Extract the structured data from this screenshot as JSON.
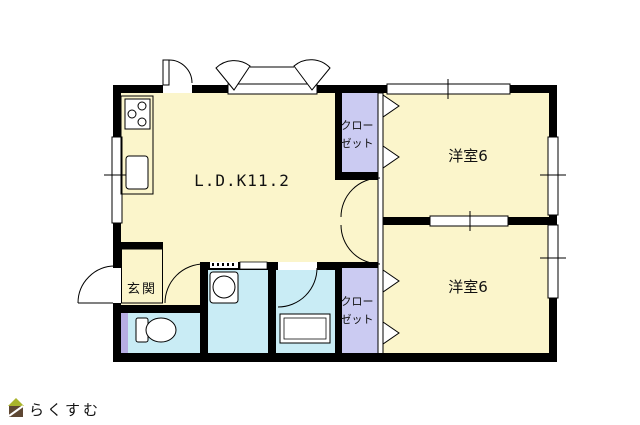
{
  "plan": {
    "type": "floor-plan",
    "rooms": {
      "ldk": {
        "label": "L.D.K11.2"
      },
      "bedroom1": {
        "label": "洋室6"
      },
      "bedroom2": {
        "label": "洋室6"
      },
      "closet1": {
        "label_line1": "クロー",
        "label_line2": "ゼット"
      },
      "closet2": {
        "label_line1": "クロー",
        "label_line2": "ゼット"
      },
      "genkan": {
        "label": "玄関"
      }
    }
  },
  "colors": {
    "room_yellow": "#FBF5CB",
    "closet_lavender": "#CBCBF2",
    "wet_cyan": "#C9ECF5",
    "toilet_door_lavender": "#B7AEE4",
    "wall_black": "#000000",
    "fixture_white": "#FFFFFF",
    "logo_text_brown": "#8A7A68",
    "logo_roof_green": "#A9B42C",
    "logo_body_brown": "#5E4733"
  },
  "logo": {
    "text": "らくすむ"
  }
}
